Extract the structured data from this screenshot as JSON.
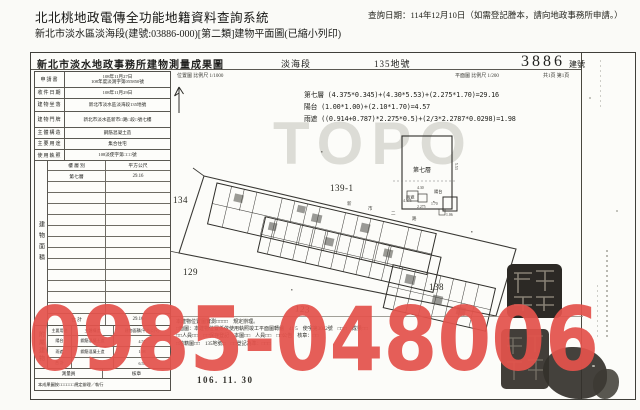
{
  "page": {
    "system_title": "北北桃地政電傳全功能地籍資料查詢系統",
    "query_date": "查詢日期：114年12月10日（如需登記謄本，請向地政事務所申請。）",
    "subtitle": "新北市淡水區淡海段(建號:03886-000)[第二類]建物平面圖(已縮小列印)"
  },
  "form_header": {
    "title": "新北市淡水地政事務所建物測量成果圖",
    "section": "淡海段",
    "parcel_no": "135地號",
    "building_no": "3886",
    "building_no_label": "建號",
    "scale_location": "位置圖 比例尺 1/1000",
    "scale_plan": "平面圖 比例尺 1/200",
    "pagination": "共1頁 第1頁"
  },
  "info_table": {
    "rows": [
      {
        "label": "申請書",
        "value": "108年11月27日",
        "value2": "108年度淡測字第055850號"
      },
      {
        "label": "收件日期",
        "value": "108年11月29日"
      },
      {
        "label": "建物坐落",
        "value": "新北市淡水區淡海段135地號"
      },
      {
        "label": "建物門牌",
        "value": "新北市淡水區新市□路□段□號七樓"
      },
      {
        "label": "主體構造",
        "value": "鋼筋混凝土造"
      },
      {
        "label": "主要用途",
        "value": "集合住宅"
      },
      {
        "label": "使用執照",
        "value": "108淡使字第□□□號"
      }
    ]
  },
  "area_table": {
    "side_label": "建物面積",
    "col_floor": "樓 層 別",
    "col_area": "平方公尺",
    "floor": "第七層",
    "floor_area": "29.16",
    "total_label": "合 計",
    "total": "29.16"
  },
  "annex_table": {
    "side_label": "附屬建物",
    "h_use": "主要用途",
    "h_structure": "主體構造",
    "h_area": "建物面積(平方公尺)",
    "rows": [
      {
        "use": "陽台",
        "structure": "鋼筋混凝土造",
        "area": "4.57"
      },
      {
        "use": "雨遮",
        "structure": "鋼筋混凝土造",
        "area": "1.98"
      }
    ],
    "total_label": "合 計",
    "total": "6.55"
  },
  "footer": {
    "sign_label": "測量員",
    "check_label": "核章",
    "note": "本成果圖按□□□□□□規定辦理／執行",
    "date_stamp": "106. 11. 30"
  },
  "calc_lines": {
    "l1": "第七層 (4.375*0.345)+(4.30*5.53)+(2.275*1.70)=29.16",
    "l2": "陽台 (1.00*1.00)+(2.10*1.70)=4.57",
    "l3": "雨遮 ((0.914+0.787)*2.275*0.5)+(2/3*2.2787*0.0298)=1.98"
  },
  "plan": {
    "parcel_134": "134",
    "parcel_139": "139-1",
    "parcel_129": "129",
    "parcel_138": "138",
    "parcel_123": "123",
    "road_chars": [
      "新",
      "市",
      "二",
      "路"
    ],
    "unit_label": "第七層",
    "dim_553": "5.53",
    "dim_430": "4.30",
    "dim_4375": "4.375",
    "dim_2275": "2.275",
    "dim_170": "1.70",
    "dim_106": "1.06",
    "lbl_balcony": "陽台",
    "lbl_canopy": "雨遮"
  },
  "notes": {
    "n1": "本建物位置圖實測□□□□　規定辦理。",
    "n2": "□面圖：本建物位置係依使用執照竣工平面圖轉繪　41 5　使字第3042號　□□□　成果□□",
    "n3": "□□人員□□　□□保存登記　本圖□□　人員□□　□□公告　核章：□□",
    "n4": "□地籍圖□□　135地號□　□□登記為準：□□□"
  },
  "watermarks": {
    "phone": "0985-048006",
    "topo": "TOPO"
  }
}
